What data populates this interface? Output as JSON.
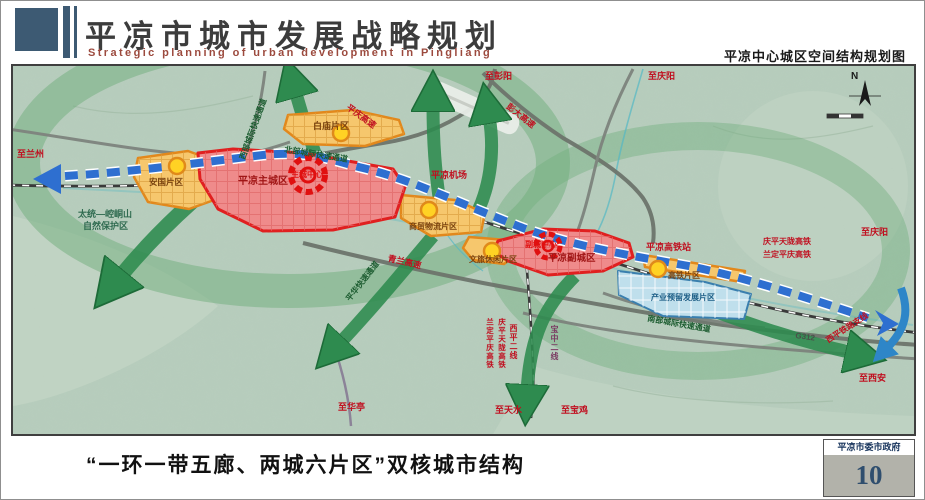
{
  "header": {
    "title": "平凉市城市发展战略规划",
    "subtitle_en": "Strategic planning of urban development in Pingliang",
    "map_title": "平凉中心城区空间结构规划图"
  },
  "footer": {
    "caption": "“一环一带五廊、两城六片区”双核城市结构",
    "gov": "平凉市委市政府",
    "page_number": "10"
  },
  "map": {
    "compass_n": "N",
    "labels": {
      "zhi_lanzhou": "至兰州",
      "nature_reserve_1": "太统—崆峒山",
      "nature_reserve_2": "自然保护区",
      "zhi_pengyang": "至彭阳",
      "zhi_qingyang_top": "至庆阳",
      "pengda_expwy": "彭大高速",
      "pingqing_expwy": "平庆高速",
      "north_corridor": "北部城际快速通道",
      "west_corridor": "西部城际快速通道",
      "airport": "平凉机场",
      "baimiao_area": "白庙片区",
      "main_city": "平凉主城区",
      "main_center": "主城中心",
      "anguo_area": "安国片区",
      "logistics_area": "商贸物流片区",
      "wenlv_area": "文旅休闲片区",
      "sub_city": "平凉副城区",
      "sub_center": "副城中心",
      "hsr_station": "平凉高铁站",
      "hsr_area": "高铁片区",
      "qptl_hsr": "庆平天陇高铁",
      "ldpq_hsr": "兰定平庆高铁",
      "zhi_qingyang_right": "至庆阳",
      "industry_reserve_area": "产业预留发展片区",
      "south_corridor": "南部城际快速通道",
      "g312": "G312",
      "xiping_branch": "西平铁路支线",
      "zhi_xian": "至西安",
      "qinglan_expwy": "青兰高速",
      "pinghua_corridor": "平华快速通道",
      "zhi_huating": "至华亭",
      "zhi_tianshui": "至天水",
      "zhi_baoji": "至宝鸡",
      "xiping_line2": "西平二线",
      "baozhong_line2": "宝中二线",
      "qptl_hsr_v": "庆平天陇高铁",
      "ldpq_hsr_v": "兰定平庆高铁"
    }
  },
  "colors": {
    "header_blue": "#3d5a73",
    "subtitle_red": "#9c4a3e",
    "terrain_green": "#b7cdbd",
    "corridor_green": "#2e8b4f",
    "band_blue": "#2e6fd0",
    "red_zone": "#ef8b8b",
    "orange_zone": "#f6c76d",
    "blue_zone": "#bfdfec",
    "node_yellow": "#ffd224",
    "page_number_blue": "#2f4e6e"
  }
}
